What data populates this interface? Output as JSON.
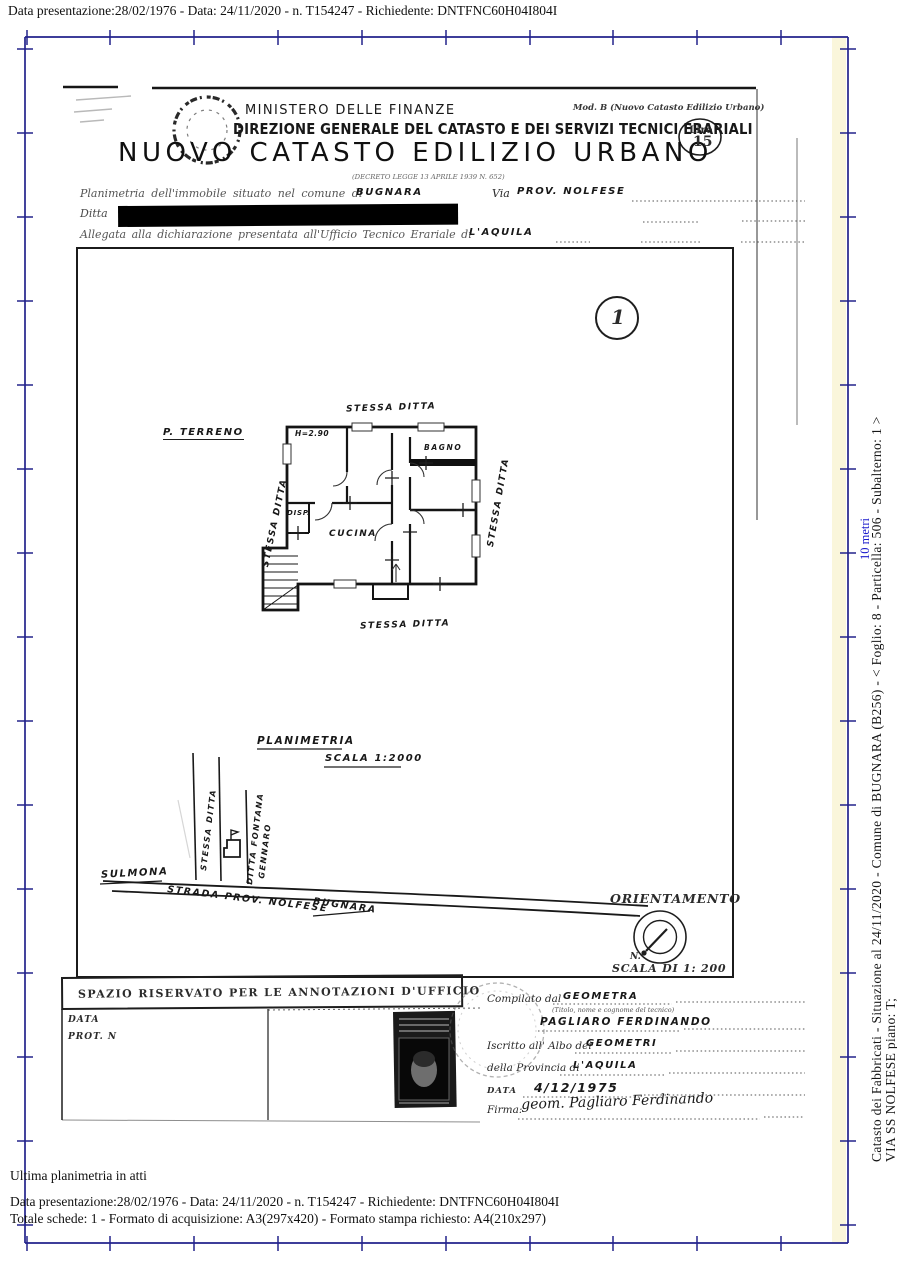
{
  "page": {
    "width": 897,
    "height": 1261,
    "frame_color": "#23238c",
    "top_bar": "Data presentazione:28/02/1976 - Data: 24/11/2020 - n. T154247 - Richiedente: DNTFNC60H04I804I",
    "bottom_lines": {
      "status": "Ultima planimetria in atti",
      "info": "Data presentazione:28/02/1976 - Data: 24/11/2020 - n. T154247 - Richiedente: DNTFNC60H04I804I",
      "formats": "Totale schede: 1 - Formato di acquisizione: A3(297x420)  - Formato stampa richiesto: A4(210x297)"
    },
    "right_margin": {
      "catasto_line": "Catasto dei Fabbricati - Situazione al 24/11/2020 - Comune di BUGNARA (B256) - < Foglio: 8 - Particella: 506 - Subalterno: 1 >",
      "address_line": "VIA SS NOLFESE piano: T;",
      "scale_link": "10 metri",
      "link_color": "#1a1acc"
    }
  },
  "document": {
    "mod_label": "Mod. B (Nuovo Catasto Edilizio Urbano)",
    "ministry": "MINISTERO DELLE FINANZE",
    "directorate": "DIREZIONE GENERALE DEL CATASTO E DEI SERVIZI TECNICI ERARIALI",
    "title": "NUOVO CATASTO EDILIZIO URBANO",
    "decree": "(DECRETO LEGGE 13 APRILE 1939 N. 652)",
    "stamp": {
      "currency": "Lire",
      "value": "15"
    },
    "form": {
      "location_label": "Planimetria dell'immobile situato nel comune di",
      "location_value": "BUGNARA",
      "street_label": "Via",
      "street_value": "PROV. NOLFESE",
      "owner_label": "Ditta",
      "office_label": "Allegata alla dichiarazione presentata all'Ufficio Tecnico Erariale di",
      "office_value": "L'AQUILA"
    },
    "sheet_number": "1",
    "plan": {
      "floor_label": "P. TERRENO",
      "height_note": "H=2.90",
      "room_kitchen": "CUCINA",
      "room_bath": "BAGNO",
      "room_pantry": "DISP.",
      "boundary_top": "STESSA DITTA",
      "boundary_left": "STESSA DITTA",
      "boundary_right": "STESSA DITTA",
      "boundary_bottom": "STESSA DITTA"
    },
    "site_map": {
      "caption": "PLANIMETRIA",
      "scale": "SCALA 1:2000",
      "town_left": "SULMONA",
      "road": "STRADA PROV. NOLFESE",
      "town_right": "BUGNARA",
      "parcel_same_owner": "STESSA DITTA",
      "parcel_neighbour_1": "DITTA FONTANA",
      "parcel_neighbour_2": "GENNARO"
    },
    "compass": {
      "title": "ORIENTAMENTO",
      "north": "N.",
      "scale": "SCALA DI 1: 200"
    },
    "annotations": {
      "header": "SPAZIO RISERVATO PER LE ANNOTAZIONI D'UFFICIO",
      "date_label": "DATA",
      "protocol_label": "PROT. N"
    },
    "compiler": {
      "compiled_by_label": "Compilato dal",
      "role_value": "GEOMETRA",
      "role_note": "(Titolo, nome e cognome del tecnico)",
      "name_value": "PAGLIARO FERDINANDO",
      "register_label": "Iscritto all' Albo dei",
      "register_value": "GEOMETRI",
      "province_label": "della Provincia di",
      "province_value": "L'AQUILA",
      "date_label": "DATA",
      "date_value": "4/12/1975",
      "signature_label": "Firma:",
      "signature_value": "geom. Pagliaro Ferdinando"
    }
  }
}
